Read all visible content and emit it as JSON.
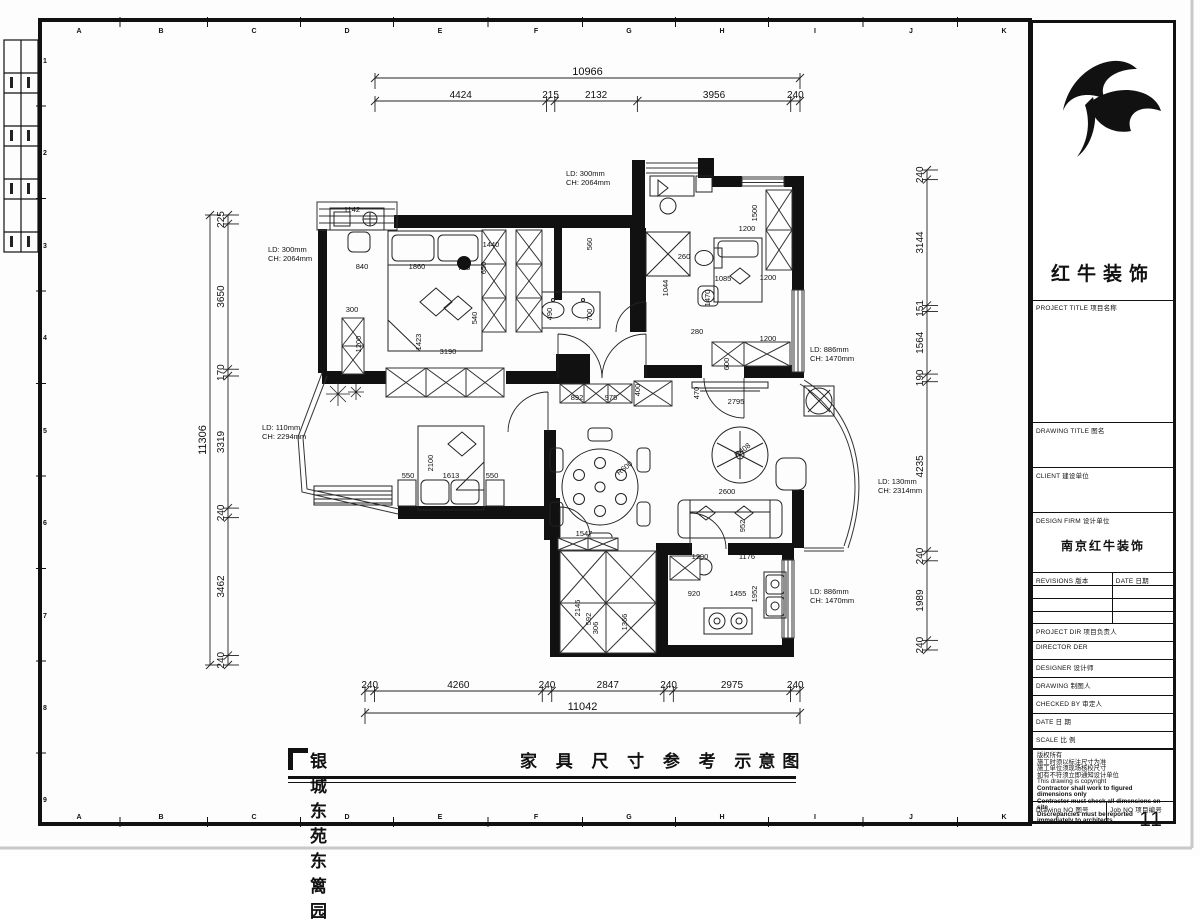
{
  "sheet": {
    "border_letters": [
      "A",
      "B",
      "C",
      "D",
      "E",
      "F",
      "G",
      "H",
      "I",
      "J",
      "K"
    ],
    "border_numbers": [
      "1",
      "2",
      "3",
      "4",
      "5",
      "6",
      "7",
      "8",
      "9"
    ]
  },
  "title_block": {
    "logo_text": "红牛装饰",
    "fields": {
      "project_title": "PROJECT TITLE 项目名称",
      "drawing_title": "DRAWING TITLE 图名",
      "client": "CLIENT 建设单位",
      "design_firm": "DESIGN FIRM 设计单位",
      "design_firm_value": "南京红牛装饰",
      "revisions": "REVISIONS 版本",
      "rev_date": "DATE 日期",
      "project_dir": "PROJECT DIR 项目负责人",
      "director": "DIRECTOR DER",
      "designer": "DESIGNER 设计师",
      "drawing": "DRAWING 制图人",
      "checked_by": "CHECKED BY 审定人",
      "date": "DATE 日 期",
      "scale": "SCALE 比 例",
      "drawing_no": "Drawing NO 图号",
      "job_no": "Job NO 项目编号",
      "job_no_value": "11"
    },
    "notes": [
      "版权所有",
      "施工时须以标注尺寸为准",
      "施工单位须现场核校尺寸",
      "如有不符须立即通知设计单位",
      "This drawing is copyright",
      "Contractor shall work to figured dimensions only",
      "Contractor must check all dimensions on site",
      "Discrepancies must be reported immediately to architects"
    ]
  },
  "footer": {
    "project_name": "银城东苑东篱园",
    "drawing_name": "家 具 尺 寸 参 考  示意图"
  },
  "plan": {
    "dim_chains": [
      {
        "name": "top-total",
        "orient": "h",
        "x1": 375,
        "x2": 800,
        "y": 78,
        "segs": [
          10966
        ]
      },
      {
        "name": "top-segments",
        "orient": "h",
        "x1": 375,
        "x2": 800,
        "y": 101,
        "segs": [
          4424,
          215,
          2132,
          3956,
          240
        ]
      },
      {
        "name": "bottom-segments",
        "orient": "h",
        "x1": 365,
        "x2": 800,
        "y": 691,
        "segs": [
          240,
          4260,
          240,
          2847,
          240,
          2975,
          240
        ]
      },
      {
        "name": "bottom-total",
        "orient": "h",
        "x1": 365,
        "x2": 800,
        "y": 713,
        "segs": [
          11042
        ]
      },
      {
        "name": "left-total",
        "orient": "v",
        "y1": 215,
        "y2": 665,
        "x": 210,
        "segs": [
          11306
        ]
      },
      {
        "name": "left-segments",
        "orient": "v",
        "y1": 215,
        "y2": 665,
        "x": 228,
        "segs": [
          225,
          3650,
          170,
          3319,
          240,
          3462,
          240
        ]
      },
      {
        "name": "right-segments",
        "orient": "v",
        "y1": 170,
        "y2": 650,
        "x": 927,
        "segs": [
          240,
          3144,
          151,
          1564,
          190,
          4235,
          240,
          1989,
          240
        ]
      }
    ],
    "labels": [
      {
        "t": "1142",
        "x": 352,
        "y": 212
      },
      {
        "t": "840",
        "x": 362,
        "y": 269
      },
      {
        "t": "1860",
        "x": 417,
        "y": 269
      },
      {
        "t": "795",
        "x": 464,
        "y": 270
      },
      {
        "t": "1440",
        "x": 491,
        "y": 247
      },
      {
        "t": "3190",
        "x": 448,
        "y": 354
      },
      {
        "t": "300",
        "x": 352,
        "y": 312
      },
      {
        "t": "892",
        "x": 577,
        "y": 400
      },
      {
        "t": "975",
        "x": 611,
        "y": 400
      },
      {
        "t": "2795",
        "x": 736,
        "y": 404
      },
      {
        "t": "1200",
        "x": 747,
        "y": 231
      },
      {
        "t": "260",
        "x": 684,
        "y": 259
      },
      {
        "t": "1085",
        "x": 723,
        "y": 281
      },
      {
        "t": "1200",
        "x": 768,
        "y": 280
      },
      {
        "t": "1200",
        "x": 768,
        "y": 341
      },
      {
        "t": "2600",
        "x": 727,
        "y": 494
      },
      {
        "t": "1547",
        "x": 584,
        "y": 536
      },
      {
        "t": "1290",
        "x": 700,
        "y": 559
      },
      {
        "t": "1176",
        "x": 747,
        "y": 559
      },
      {
        "t": "920",
        "x": 694,
        "y": 596
      },
      {
        "t": "1455",
        "x": 738,
        "y": 596
      },
      {
        "t": "550",
        "x": 408,
        "y": 478
      },
      {
        "t": "1613",
        "x": 451,
        "y": 478
      },
      {
        "t": "550",
        "x": 492,
        "y": 478
      },
      {
        "t": "280",
        "x": 697,
        "y": 334
      },
      {
        "t": "1423",
        "x": 421,
        "y": 342,
        "r": -90
      },
      {
        "t": "540",
        "x": 477,
        "y": 318,
        "r": -90
      },
      {
        "t": "1200",
        "x": 361,
        "y": 344,
        "r": -90
      },
      {
        "t": "650",
        "x": 486,
        "y": 268,
        "r": -90
      },
      {
        "t": "490",
        "x": 552,
        "y": 314,
        "r": -90
      },
      {
        "t": "700",
        "x": 592,
        "y": 315,
        "r": -90
      },
      {
        "t": "400",
        "x": 640,
        "y": 390,
        "r": -90
      },
      {
        "t": "1500",
        "x": 757,
        "y": 213,
        "r": -90
      },
      {
        "t": "1044",
        "x": 668,
        "y": 288,
        "r": -90
      },
      {
        "t": "1470",
        "x": 710,
        "y": 298,
        "r": -90
      },
      {
        "t": "600",
        "x": 729,
        "y": 364,
        "r": -90
      },
      {
        "t": "470",
        "x": 699,
        "y": 393,
        "r": -90
      },
      {
        "t": "2100",
        "x": 433,
        "y": 463,
        "r": -90
      },
      {
        "t": "952",
        "x": 745,
        "y": 526,
        "r": -90
      },
      {
        "t": "1952",
        "x": 757,
        "y": 594,
        "r": -90
      },
      {
        "t": "2146",
        "x": 580,
        "y": 608,
        "r": -90
      },
      {
        "t": "592",
        "x": 591,
        "y": 619,
        "r": -90
      },
      {
        "t": "306",
        "x": 598,
        "y": 628,
        "r": -90
      },
      {
        "t": "1366",
        "x": 627,
        "y": 622,
        "r": -90
      },
      {
        "t": "560",
        "x": 592,
        "y": 244,
        "r": -90
      },
      {
        "t": "R600",
        "x": 626,
        "y": 470,
        "r": -38
      },
      {
        "t": "R408",
        "x": 744,
        "y": 452,
        "r": -38
      }
    ],
    "window_annotations": [
      {
        "l1": "LD: 300mm",
        "l2": "CH: 2064mm",
        "x": 268,
        "y": 252
      },
      {
        "l1": "LD: 300mm",
        "l2": "CH: 2064mm",
        "x": 566,
        "y": 176
      },
      {
        "l1": "LD: 110mm",
        "l2": "CH: 2294mm",
        "x": 262,
        "y": 430
      },
      {
        "l1": "LD: 886mm",
        "l2": "CH: 1470mm",
        "x": 810,
        "y": 352
      },
      {
        "l1": "LD: 130mm",
        "l2": "CH: 2314mm",
        "x": 878,
        "y": 484
      },
      {
        "l1": "LD: 886mm",
        "l2": "CH: 1470mm",
        "x": 810,
        "y": 594
      }
    ]
  }
}
